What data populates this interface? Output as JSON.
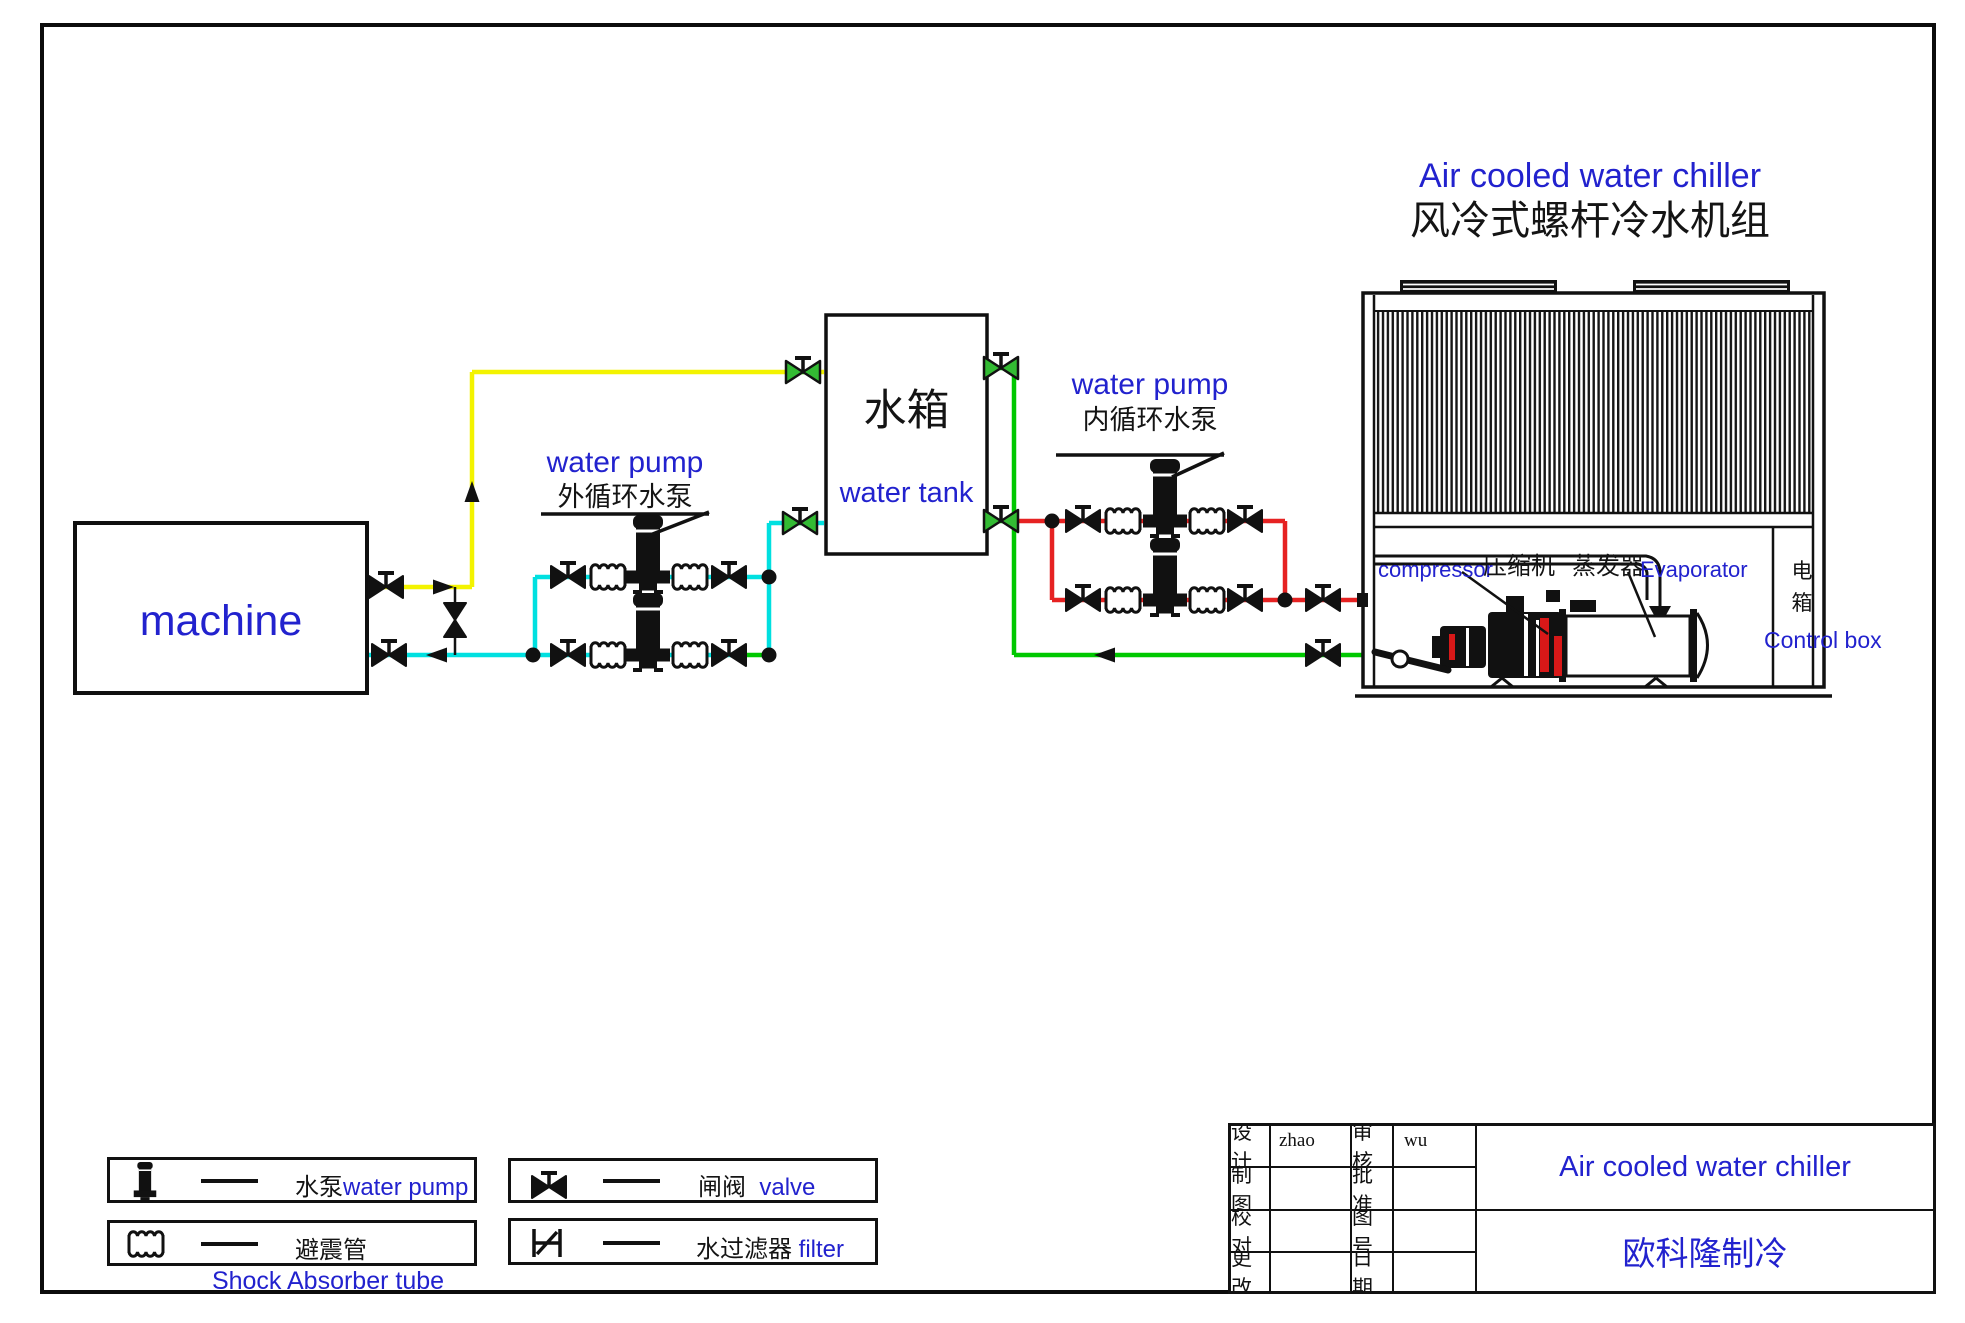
{
  "header": {
    "title_en": "Air cooled water chiller",
    "title_zh": "风冷式螺杆冷水机组"
  },
  "machine": {
    "label": "machine"
  },
  "water_tank": {
    "name_zh": "水箱",
    "name_en": "water tank"
  },
  "external_pump": {
    "label_en": "water pump",
    "label_zh": "外循环水泵"
  },
  "internal_pump": {
    "label_en": "water pump",
    "label_zh": "内循环水泵"
  },
  "chiller": {
    "compressor_en": "compressor",
    "compressor_zh": "压缩机",
    "evaporator_zh": "蒸发器",
    "evaporator_en": "Evaporator",
    "control_box_zh": "电\n箱",
    "control_box_en": "Control box"
  },
  "legend": {
    "pump_zh": "水泵",
    "pump_en": "water pump",
    "shock_zh": "避震管",
    "shock_en": "Shock Absorber tube",
    "valve_zh": "闸阀",
    "valve_en": "valve",
    "filter_zh": "水过滤器",
    "filter_en": "filter"
  },
  "title_block": {
    "rows": [
      {
        "c1": "设计",
        "c2": "zhao",
        "c3": "审核",
        "c4": "wu"
      },
      {
        "c1": "制图",
        "c2": "",
        "c3": "批准",
        "c4": ""
      },
      {
        "c1": "校对",
        "c2": "",
        "c3": "图号",
        "c4": ""
      },
      {
        "c1": "更改",
        "c2": "",
        "c3": "日期",
        "c4": ""
      }
    ],
    "product": "Air cooled water chiller",
    "company": "欧科隆制冷"
  },
  "colors": {
    "blue": "#2222CE",
    "yellow": "#F3F300",
    "cyan": "#00E0E0",
    "green": "#00C800",
    "red": "#E62222",
    "black": "#111111"
  }
}
